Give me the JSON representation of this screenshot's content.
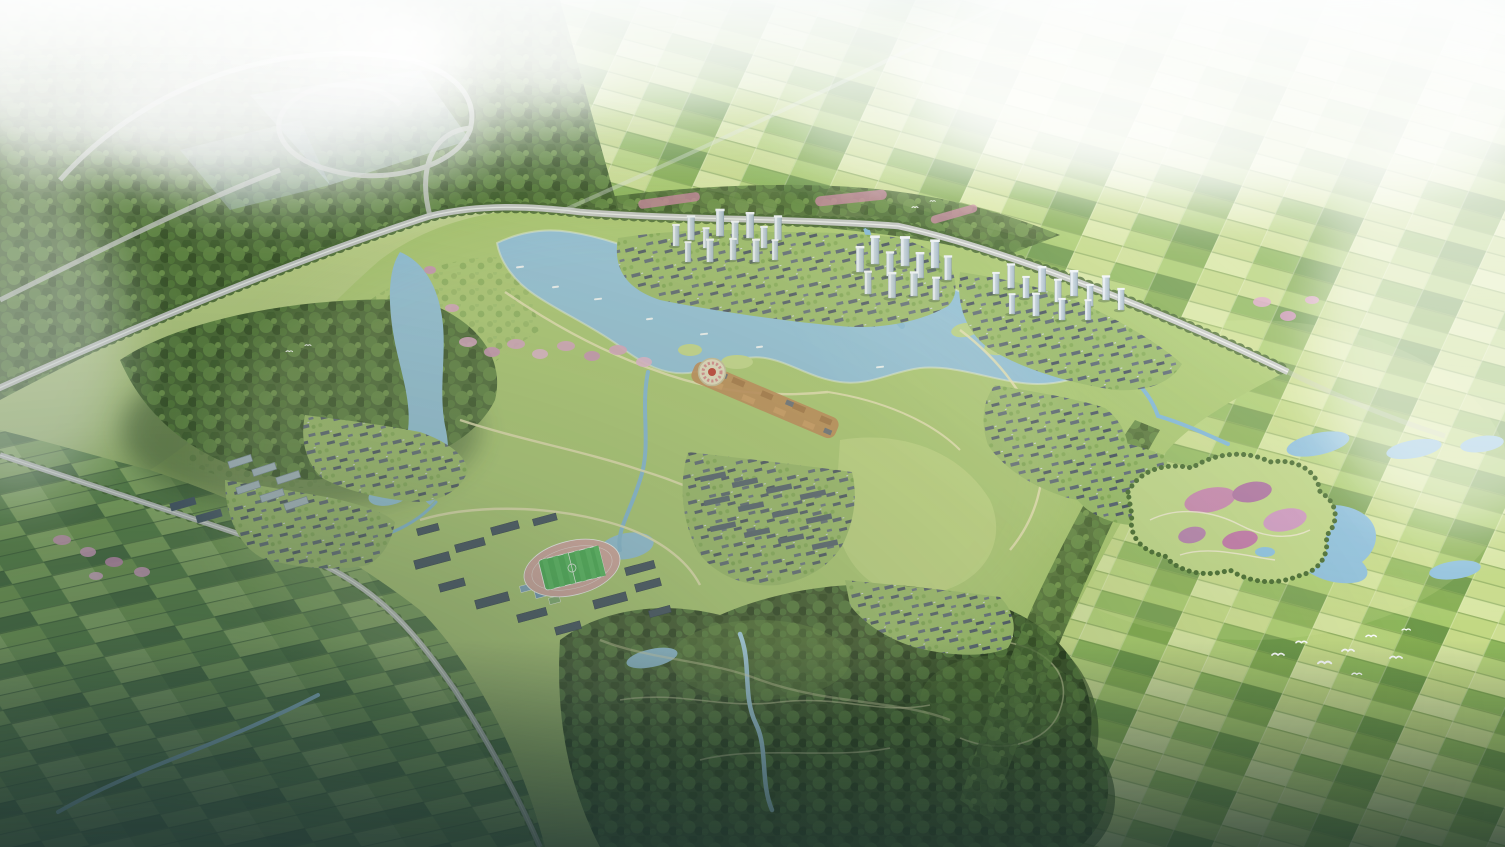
{
  "meta": {
    "width_px": 1505,
    "height_px": 847,
    "description": "Photorealistic aerial rendering of a lakeside eco-town masterplan: central blue lake with wetlands and boats, high-rise clusters along a tree-lined highway, old-town street with orange roofs, round flower plaza, campus with athletics track, village neighborhoods, large south forest with trails and creeks, checkerboard farmland fading into haze, flower park and ponds to the southeast, white egrets over the fields."
  },
  "palette": {
    "white": "#ffffff",
    "haze": "#eff5f5",
    "sky_tint": "#d9e6e4",
    "meadow": "#aecb72",
    "field_light": "#cdde92",
    "field_mid": "#a9cb6d",
    "field_dark": "#86ae52",
    "field_shadow": "#5f8a4a",
    "forest_dark": "#3e5629",
    "forest_mid": "#4c6a34",
    "forest_light": "#6f9449",
    "water": "#93c3dd",
    "water_light": "#c9e4f0",
    "river": "#85bbd8",
    "road_grey": "#c6c9c4",
    "road_light": "#eceee9",
    "path_sand": "#ece6b8",
    "roof_dark": "#55616d",
    "roof_orange": "#c08a52",
    "tower_face": "#b9c8d4",
    "blossom_pink": "#dba6c4",
    "flower_purple": "#b279a2",
    "track_pink": "#d9a9a2",
    "pitch_green": "#44b04f",
    "court_blue": "#7fa7c2",
    "dusk_shadow": "#1f332e",
    "glow_warm": "#f7f3c4"
  },
  "scene": {
    "regions": [
      "haze-sky",
      "farmland-east",
      "farmland-southwest",
      "forest-northwest",
      "highway-interchange",
      "highway",
      "central-lake",
      "west-lake-arm",
      "northeast-wetland",
      "high-rise-cluster-north",
      "high-rise-cluster-center",
      "high-rise-cluster-east",
      "lakeside-old-town",
      "round-flower-plaza",
      "campus-with-stadium",
      "athletics-track",
      "south-neighborhoods",
      "west-apartment-slabs",
      "villages",
      "flower-park-southeast",
      "southeast-ponds",
      "south-forest",
      "creeks",
      "blossom-trees",
      "egret-flock",
      "boats"
    ]
  }
}
